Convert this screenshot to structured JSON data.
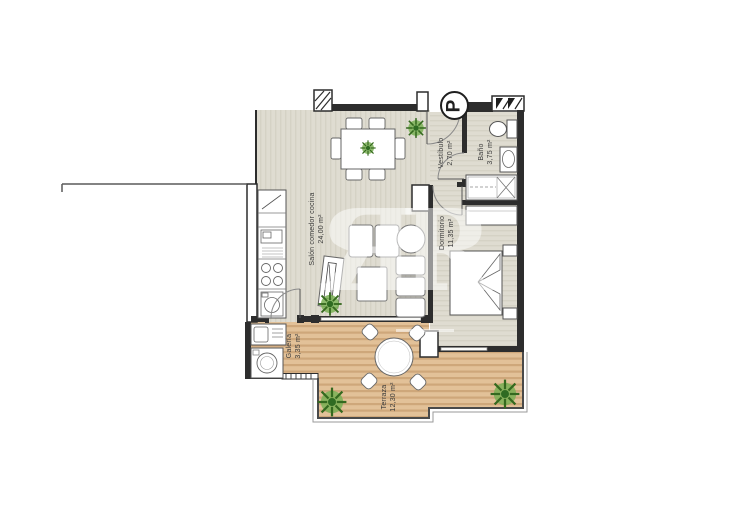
{
  "plan": {
    "entrance": {
      "symbol": "P"
    },
    "watermark": {
      "text": "ЯR"
    },
    "rooms": [
      {
        "id": "salon",
        "name": "Salón comedor cocina",
        "area": "24,00 m²"
      },
      {
        "id": "vestibulo",
        "name": "Vestíbulo",
        "area": "2,70 m²"
      },
      {
        "id": "bano",
        "name": "Baño",
        "area": "3,75 m²"
      },
      {
        "id": "dormitorio",
        "name": "Dormitorio",
        "area": "11,35 m²"
      },
      {
        "id": "galeria",
        "name": "Galería",
        "area": "3,35 m²"
      },
      {
        "id": "terraza",
        "name": "Terraza",
        "area": "12,30 m²"
      }
    ],
    "colors": {
      "interior_floor": "#dfdcd1",
      "interior_floor_stripe": "#d5d2c5",
      "wood_floor": "#e2c198",
      "wood_floor_stripe": "#cea77a",
      "wall": "#2d2d2d",
      "plant_green": "#5c9a3f"
    }
  }
}
